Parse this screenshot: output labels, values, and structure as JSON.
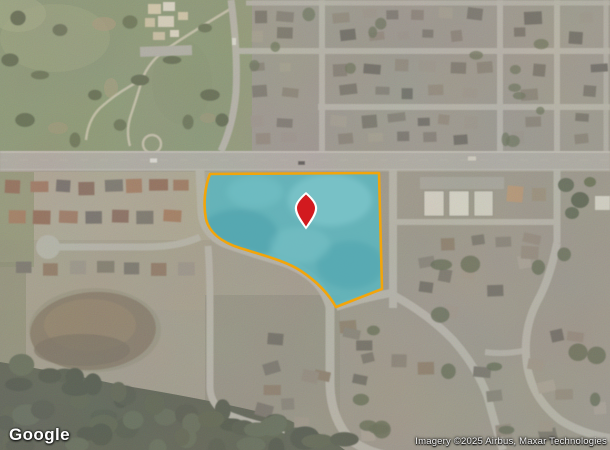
{
  "map": {
    "provider_logo": "Google",
    "attribution": "Imagery ©2025 Airbus, Maxar Technologies",
    "view_type": "satellite",
    "parcel": {
      "fill_color": "#5bb7c1",
      "stroke_color": "#f2a50a"
    },
    "pin": {
      "color": "#d21a1f",
      "outline_color": "#ffffff"
    }
  }
}
